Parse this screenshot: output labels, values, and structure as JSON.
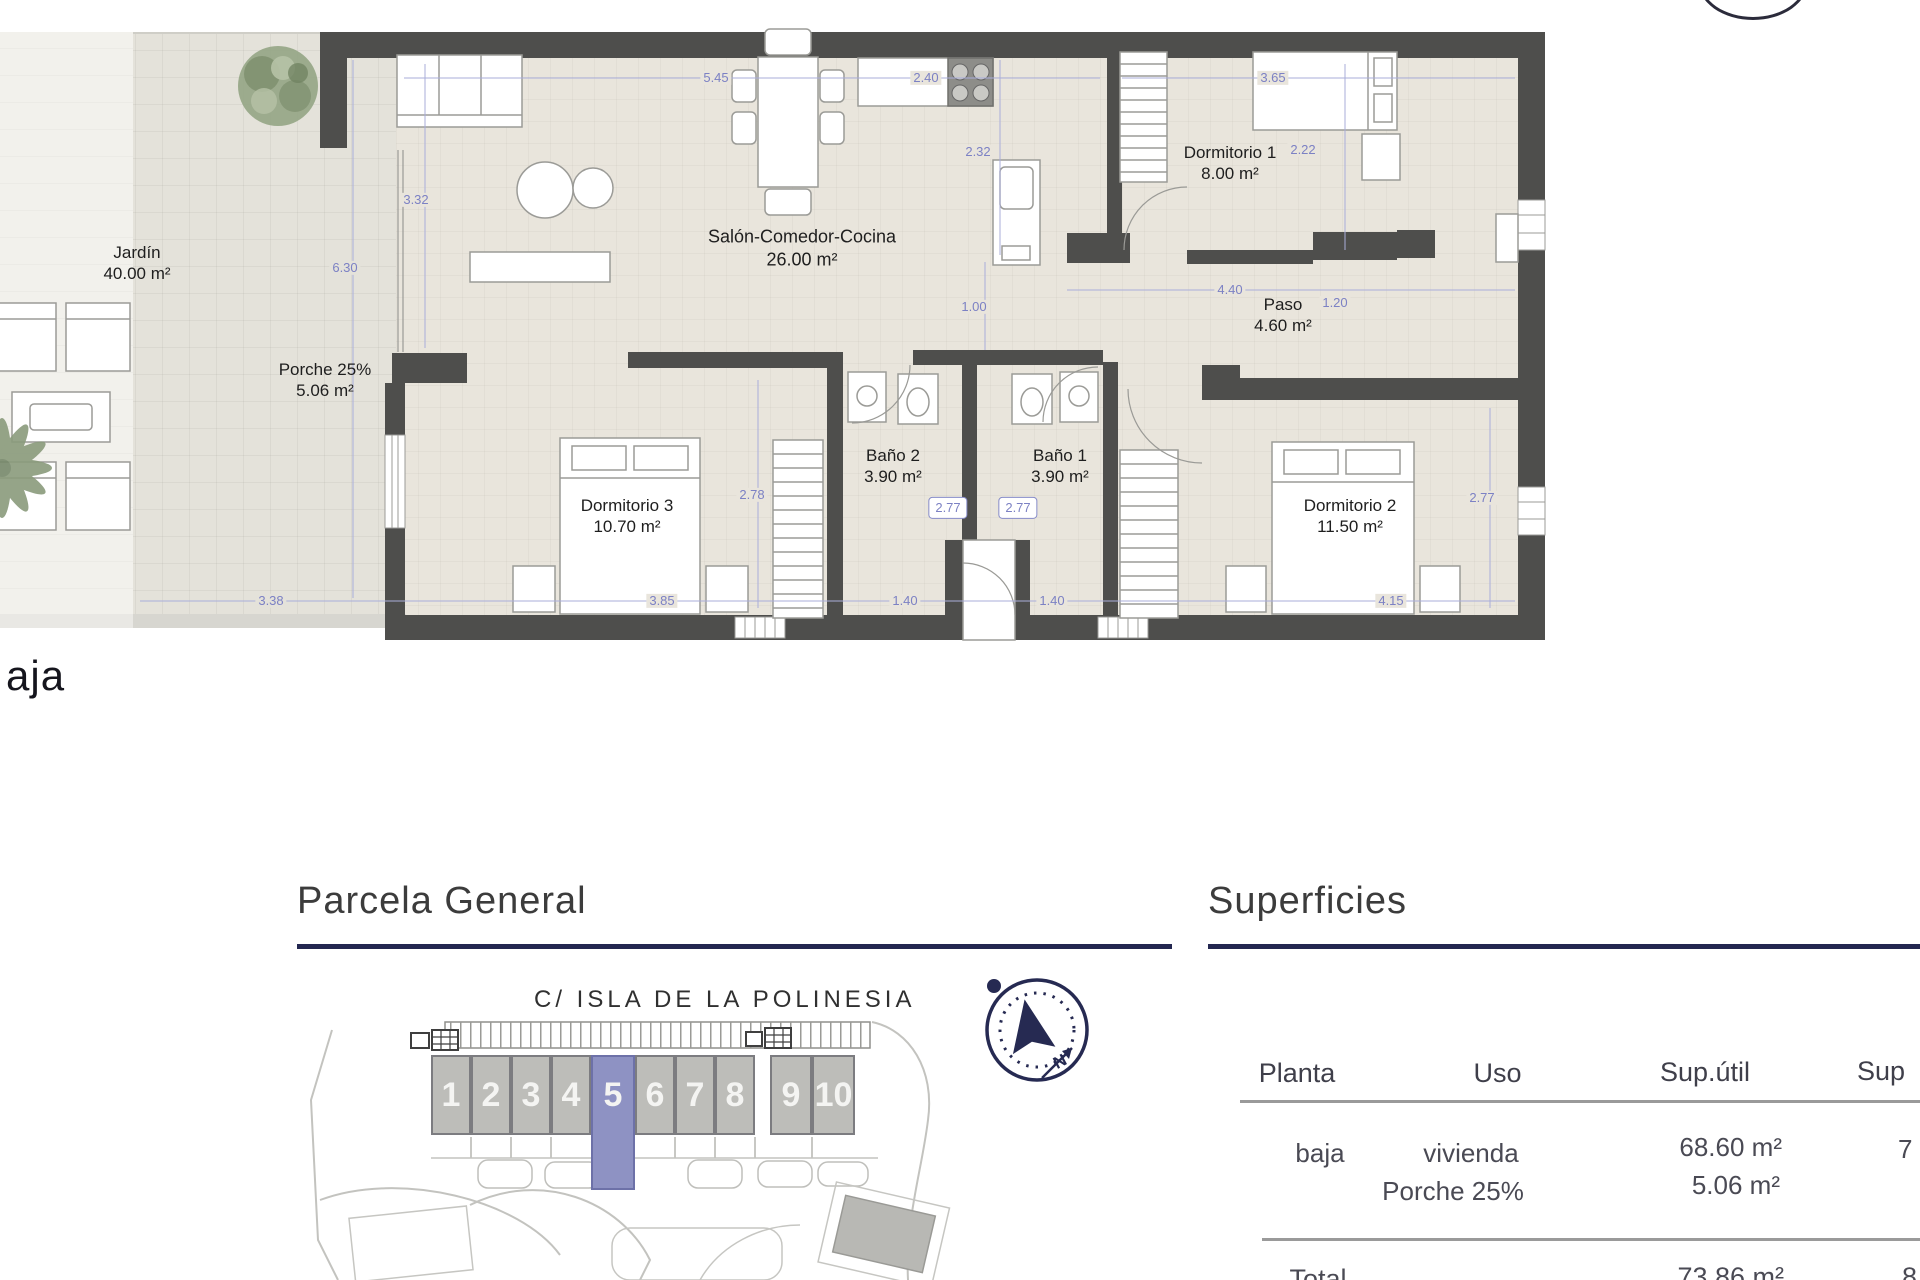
{
  "plan": {
    "floor_label": "aja",
    "rooms": [
      {
        "name": "Jardín",
        "area": "40.00 m²"
      },
      {
        "name": "Porche 25%",
        "area": "5.06 m²"
      },
      {
        "name": "Salón-Comedor-Cocina",
        "area": "26.00 m²"
      },
      {
        "name": "Dormitorio 1",
        "area": "8.00 m²"
      },
      {
        "name": "Paso",
        "area": "4.60 m²"
      },
      {
        "name": "Baño 2",
        "area": "3.90 m²"
      },
      {
        "name": "Baño 1",
        "area": "3.90 m²"
      },
      {
        "name": "Dormitorio 3",
        "area": "10.70 m²"
      },
      {
        "name": "Dormitorio 2",
        "area": "11.50 m²"
      }
    ],
    "dims": {
      "salon_width": "5.45",
      "kitchen_width": "2.40",
      "dorm1_width": "3.65",
      "kitchen_depth": "2.32",
      "dorm1_depth": "2.22",
      "salon_depth": "3.32",
      "porch_length": "6.30",
      "hall_width": "1.00",
      "paso_width": "4.40",
      "paso_right": "1.20",
      "dorm3_depth": "2.78",
      "bano2_box": "2.77",
      "bano1_box": "2.77",
      "dorm2_depth": "2.77",
      "garden_bottom": "3.38",
      "dorm3_width": "3.85",
      "bano2_width": "1.40",
      "bano1_width": "1.40",
      "dorm2_width": "4.15"
    }
  },
  "parcela": {
    "title": "Parcela General",
    "street": "C/ ISLA DE LA POLINESIA",
    "units": [
      "1",
      "2",
      "3",
      "4",
      "5",
      "6",
      "7",
      "8",
      "9",
      "10"
    ],
    "highlighted_unit": "5"
  },
  "compass": {
    "north_label": "N"
  },
  "superficies": {
    "title": "Superficies",
    "columns": {
      "planta": "Planta",
      "uso": "Uso",
      "sup_util": "Sup.útil",
      "sup_right": "Sup"
    },
    "row": {
      "planta": "baja",
      "uso_line1": "vivienda",
      "uso_line2": "Porche 25%",
      "sup_util_line1": "68.60 m²",
      "sup_util_line2": "5.06 m²",
      "sup_right": "7"
    },
    "total": {
      "label": "Total",
      "sup_util": "73.86 m²",
      "sup_right": "8"
    }
  },
  "colors": {
    "accent_navy": "#232750",
    "unit_highlight": "#8e92c3",
    "wall": "#4e4e4c",
    "dimension_blue": "#7c81c4"
  }
}
